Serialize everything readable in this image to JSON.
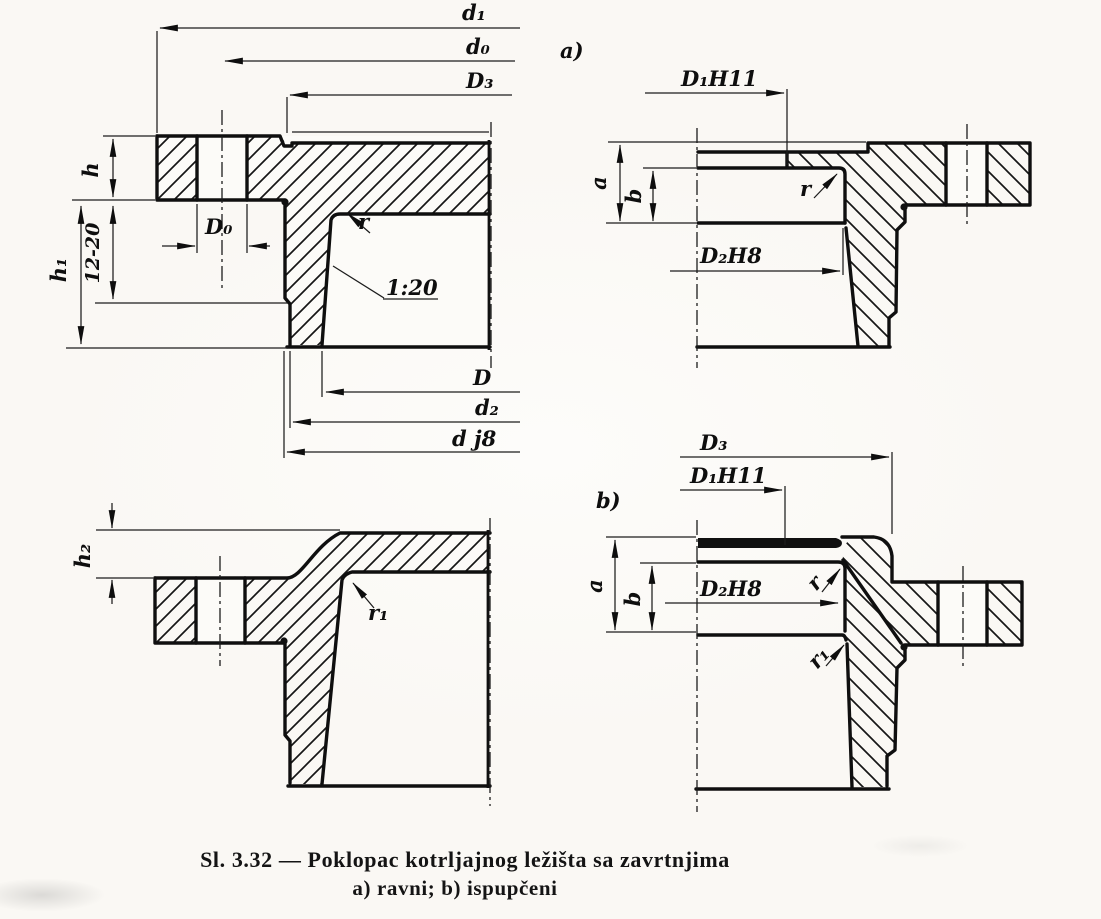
{
  "figure": {
    "caption_line1": "Sl. 3.32 — Poklopac kotrljajnog ležišta sa zavrtnjima",
    "caption_line2": "a) ravni; b) ispupčeni"
  },
  "views": {
    "flat_left": {
      "d1": "d₁",
      "d0": "d₀",
      "D3": "D₃",
      "h": "h",
      "range12": "12-20",
      "h1": "h₁",
      "D0": "D₀",
      "r": "r",
      "taper": "1:20",
      "D": "D",
      "d2": "d₂",
      "dj8": "d j8"
    },
    "flat_right": {
      "tag": "a)",
      "D1": "D₁H11",
      "a": "a",
      "b": "b",
      "r": "r",
      "D2": "D₂H8"
    },
    "convex_left": {
      "h2": "h₂",
      "r1": "r₁"
    },
    "convex_right": {
      "tag": "b)",
      "D3": "D₃",
      "D1": "D₁H11",
      "a": "a",
      "b": "b",
      "D2": "D₂H8",
      "r": "r",
      "r1": "r₁"
    }
  }
}
